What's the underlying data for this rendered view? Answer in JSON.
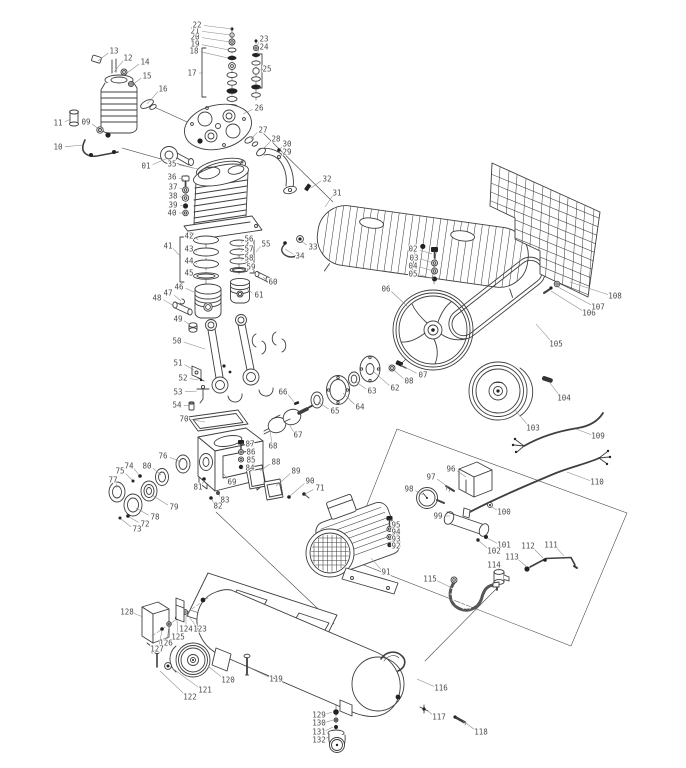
{
  "figure": {
    "type": "exploded-parts-diagram",
    "subject": "Belt-driven piston air compressor exploded view with numbered callouts",
    "canvas": {
      "width": 686,
      "height": 768
    },
    "colors": {
      "background": "#ffffff",
      "line": "#3f3f3f",
      "label": "#4a4a4a",
      "leader": "#8a8a8a"
    },
    "label_font_size": 7.5,
    "part_numbers_range": "01-132"
  },
  "callouts": [
    {
      "id": "01",
      "x": 146,
      "y": 166,
      "tx": 168,
      "ty": 158
    },
    {
      "id": "02",
      "x": 413,
      "y": 249,
      "tx": 432,
      "ty": 254
    },
    {
      "id": "03",
      "x": 414,
      "y": 258,
      "tx": 433,
      "ty": 263
    },
    {
      "id": "04",
      "x": 413,
      "y": 266,
      "tx": 433,
      "ty": 271
    },
    {
      "id": "05",
      "x": 413,
      "y": 274,
      "tx": 434,
      "ty": 279
    },
    {
      "id": "06",
      "x": 386,
      "y": 289,
      "tx": 407,
      "ty": 306
    },
    {
      "id": "07",
      "x": 423,
      "y": 375,
      "tx": 401,
      "ty": 365
    },
    {
      "id": "08",
      "x": 409,
      "y": 381,
      "tx": 393,
      "ty": 369
    },
    {
      "id": "09",
      "x": 86,
      "y": 122,
      "tx": 100,
      "ty": 130
    },
    {
      "id": "10",
      "x": 58,
      "y": 147,
      "tx": 83,
      "ty": 145
    },
    {
      "id": "11",
      "x": 58,
      "y": 123,
      "tx": 71,
      "ty": 119
    },
    {
      "id": "12",
      "x": 128,
      "y": 58,
      "tx": 114,
      "ty": 72
    },
    {
      "id": "13",
      "x": 114,
      "y": 51,
      "tx": 98,
      "ty": 61
    },
    {
      "id": "14",
      "x": 145,
      "y": 62,
      "tx": 127,
      "ty": 73
    },
    {
      "id": "15",
      "x": 147,
      "y": 76,
      "tx": 132,
      "ty": 85
    },
    {
      "id": "16",
      "x": 163,
      "y": 89,
      "tx": 147,
      "ty": 104
    },
    {
      "id": "17",
      "x": 192,
      "y": 73,
      "tx": 203,
      "ty": 73
    },
    {
      "id": "18",
      "x": 194,
      "y": 51,
      "tx": 228,
      "ty": 58
    },
    {
      "id": "19",
      "x": 195,
      "y": 44,
      "tx": 229,
      "ty": 50
    },
    {
      "id": "20",
      "x": 195,
      "y": 37,
      "tx": 230,
      "ty": 42
    },
    {
      "id": "21",
      "x": 195,
      "y": 31,
      "tx": 231,
      "ty": 35
    },
    {
      "id": "22",
      "x": 197,
      "y": 25,
      "tx": 232,
      "ty": 29
    },
    {
      "id": "23",
      "x": 264,
      "y": 39,
      "tx": 257,
      "ty": 46
    },
    {
      "id": "24",
      "x": 264,
      "y": 47,
      "tx": 257,
      "ty": 54
    },
    {
      "id": "25",
      "x": 267,
      "y": 69,
      "tx": 261,
      "ty": 70
    },
    {
      "id": "26",
      "x": 259,
      "y": 108,
      "tx": 243,
      "ty": 114
    },
    {
      "id": "27",
      "x": 263,
      "y": 130,
      "tx": 251,
      "ty": 139
    },
    {
      "id": "28",
      "x": 276,
      "y": 139,
      "tx": 264,
      "ty": 148
    },
    {
      "id": "29",
      "x": 287,
      "y": 152,
      "tx": 281,
      "ty": 156
    },
    {
      "id": "30",
      "x": 287,
      "y": 144,
      "tx": 280,
      "ty": 150
    },
    {
      "id": "31",
      "x": 337,
      "y": 193,
      "tx": 325,
      "ty": 207
    },
    {
      "id": "32",
      "x": 327,
      "y": 179,
      "tx": 311,
      "ty": 188
    },
    {
      "id": "33",
      "x": 313,
      "y": 247,
      "tx": 300,
      "ty": 240
    },
    {
      "id": "34",
      "x": 300,
      "y": 256,
      "tx": 285,
      "ty": 249
    },
    {
      "id": "35",
      "x": 172,
      "y": 164,
      "tx": 198,
      "ty": 169
    },
    {
      "id": "36",
      "x": 172,
      "y": 177,
      "tx": 184,
      "ty": 180
    },
    {
      "id": "37",
      "x": 173,
      "y": 187,
      "tx": 184,
      "ty": 190
    },
    {
      "id": "38",
      "x": 173,
      "y": 196,
      "tx": 184,
      "ty": 198
    },
    {
      "id": "39",
      "x": 173,
      "y": 205,
      "tx": 184,
      "ty": 206
    },
    {
      "id": "40",
      "x": 172,
      "y": 213,
      "tx": 184,
      "ty": 213
    },
    {
      "id": "41",
      "x": 168,
      "y": 246,
      "tx": 181,
      "ty": 257
    },
    {
      "id": "42",
      "x": 189,
      "y": 236,
      "tx": 198,
      "ty": 240
    },
    {
      "id": "43",
      "x": 189,
      "y": 249,
      "tx": 197,
      "ty": 252
    },
    {
      "id": "44",
      "x": 189,
      "y": 261,
      "tx": 197,
      "ty": 264
    },
    {
      "id": "45",
      "x": 189,
      "y": 273,
      "tx": 197,
      "ty": 276
    },
    {
      "id": "46",
      "x": 179,
      "y": 287,
      "tx": 196,
      "ty": 293
    },
    {
      "id": "47",
      "x": 168,
      "y": 293,
      "tx": 181,
      "ty": 301
    },
    {
      "id": "48",
      "x": 157,
      "y": 298,
      "tx": 174,
      "ty": 306
    },
    {
      "id": "49",
      "x": 178,
      "y": 319,
      "tx": 190,
      "ty": 325
    },
    {
      "id": "50",
      "x": 177,
      "y": 341,
      "tx": 205,
      "ty": 349
    },
    {
      "id": "51",
      "x": 178,
      "y": 363,
      "tx": 194,
      "ty": 370
    },
    {
      "id": "52",
      "x": 183,
      "y": 378,
      "tx": 198,
      "ty": 380
    },
    {
      "id": "53",
      "x": 178,
      "y": 392,
      "tx": 197,
      "ty": 391
    },
    {
      "id": "54",
      "x": 177,
      "y": 405,
      "tx": 190,
      "ty": 406
    },
    {
      "id": "55",
      "x": 266,
      "y": 244,
      "tx": 256,
      "ty": 252
    },
    {
      "id": "56",
      "x": 249,
      "y": 239,
      "tx": 241,
      "ty": 243
    },
    {
      "id": "57",
      "x": 249,
      "y": 249,
      "tx": 241,
      "ty": 252
    },
    {
      "id": "58",
      "x": 249,
      "y": 258,
      "tx": 241,
      "ty": 261
    },
    {
      "id": "59",
      "x": 251,
      "y": 267,
      "tx": 242,
      "ty": 270
    },
    {
      "id": "60",
      "x": 273,
      "y": 282,
      "tx": 263,
      "ty": 277
    },
    {
      "id": "61",
      "x": 259,
      "y": 295,
      "tx": 247,
      "ty": 289
    },
    {
      "id": "62",
      "x": 395,
      "y": 388,
      "tx": 374,
      "ty": 372
    },
    {
      "id": "63",
      "x": 372,
      "y": 391,
      "tx": 355,
      "ty": 381
    },
    {
      "id": "64",
      "x": 360,
      "y": 407,
      "tx": 343,
      "ty": 393
    },
    {
      "id": "65",
      "x": 335,
      "y": 411,
      "tx": 318,
      "ty": 402
    },
    {
      "id": "66",
      "x": 283,
      "y": 392,
      "tx": 294,
      "ty": 402
    },
    {
      "id": "67",
      "x": 298,
      "y": 435,
      "tx": 289,
      "ty": 424
    },
    {
      "id": "68",
      "x": 273,
      "y": 446,
      "tx": 270,
      "ty": 430
    },
    {
      "id": "69",
      "x": 232,
      "y": 482,
      "tx": 223,
      "ty": 473
    },
    {
      "id": "70",
      "x": 184,
      "y": 419,
      "tx": 205,
      "ty": 422
    },
    {
      "id": "71",
      "x": 320,
      "y": 488,
      "tx": 305,
      "ty": 494
    },
    {
      "id": "72",
      "x": 145,
      "y": 524,
      "tx": 129,
      "ty": 517
    },
    {
      "id": "73",
      "x": 137,
      "y": 529,
      "tx": 121,
      "ty": 519
    },
    {
      "id": "74",
      "x": 129,
      "y": 466,
      "tx": 139,
      "ty": 475
    },
    {
      "id": "75",
      "x": 120,
      "y": 471,
      "tx": 132,
      "ty": 480
    },
    {
      "id": "76",
      "x": 163,
      "y": 456,
      "tx": 181,
      "ty": 462
    },
    {
      "id": "77",
      "x": 113,
      "y": 480,
      "tx": 117,
      "ty": 488
    },
    {
      "id": "78",
      "x": 155,
      "y": 517,
      "tx": 136,
      "ty": 508
    },
    {
      "id": "79",
      "x": 174,
      "y": 507,
      "tx": 152,
      "ty": 495
    },
    {
      "id": "80",
      "x": 147,
      "y": 466,
      "tx": 161,
      "ty": 475
    },
    {
      "id": "81",
      "x": 198,
      "y": 487,
      "tx": 204,
      "ty": 480
    },
    {
      "id": "82",
      "x": 218,
      "y": 506,
      "tx": 212,
      "ty": 499
    },
    {
      "id": "83",
      "x": 225,
      "y": 500,
      "tx": 219,
      "ty": 494
    },
    {
      "id": "84",
      "x": 250,
      "y": 468,
      "tx": 242,
      "ty": 467
    },
    {
      "id": "85",
      "x": 251,
      "y": 460,
      "tx": 242,
      "ty": 459
    },
    {
      "id": "86",
      "x": 251,
      "y": 452,
      "tx": 242,
      "ty": 451
    },
    {
      "id": "87",
      "x": 250,
      "y": 444,
      "tx": 242,
      "ty": 443
    },
    {
      "id": "88",
      "x": 276,
      "y": 462,
      "tx": 260,
      "ty": 471
    },
    {
      "id": "89",
      "x": 296,
      "y": 471,
      "tx": 276,
      "ty": 486
    },
    {
      "id": "90",
      "x": 310,
      "y": 481,
      "tx": 290,
      "ty": 496
    },
    {
      "id": "91",
      "x": 386,
      "y": 572,
      "tx": 371,
      "ty": 558
    },
    {
      "id": "92",
      "x": 396,
      "y": 546,
      "tx": 391,
      "ty": 545
    },
    {
      "id": "93",
      "x": 396,
      "y": 539,
      "tx": 391,
      "ty": 537
    },
    {
      "id": "94",
      "x": 396,
      "y": 532,
      "tx": 391,
      "ty": 529
    },
    {
      "id": "95",
      "x": 396,
      "y": 525,
      "tx": 391,
      "ty": 519
    },
    {
      "id": "96",
      "x": 451,
      "y": 469,
      "tx": 466,
      "ty": 477
    },
    {
      "id": "97",
      "x": 431,
      "y": 477,
      "tx": 448,
      "ty": 487
    },
    {
      "id": "98",
      "x": 409,
      "y": 489,
      "tx": 423,
      "ty": 495
    },
    {
      "id": "99",
      "x": 438,
      "y": 516,
      "tx": 450,
      "ty": 516
    },
    {
      "id": "100",
      "x": 504,
      "y": 512,
      "tx": 490,
      "ty": 506
    },
    {
      "id": "101",
      "x": 504,
      "y": 545,
      "tx": 487,
      "ty": 538
    },
    {
      "id": "102",
      "x": 494,
      "y": 551,
      "tx": 479,
      "ty": 541
    },
    {
      "id": "103",
      "x": 533,
      "y": 428,
      "tx": 515,
      "ty": 410
    },
    {
      "id": "104",
      "x": 564,
      "y": 398,
      "tx": 550,
      "ty": 383
    },
    {
      "id": "105",
      "x": 556,
      "y": 344,
      "tx": 536,
      "ty": 324
    },
    {
      "id": "106",
      "x": 589,
      "y": 313,
      "tx": 551,
      "ty": 291
    },
    {
      "id": "107",
      "x": 598,
      "y": 307,
      "tx": 558,
      "ty": 287
    },
    {
      "id": "108",
      "x": 615,
      "y": 296,
      "tx": 570,
      "ty": 282
    },
    {
      "id": "109",
      "x": 598,
      "y": 436,
      "tx": 576,
      "ty": 429
    },
    {
      "id": "110",
      "x": 597,
      "y": 482,
      "tx": 567,
      "ty": 472
    },
    {
      "id": "111",
      "x": 551,
      "y": 545,
      "tx": 564,
      "ty": 556
    },
    {
      "id": "112",
      "x": 528,
      "y": 546,
      "tx": 543,
      "ty": 558
    },
    {
      "id": "113",
      "x": 512,
      "y": 557,
      "tx": 527,
      "ty": 567
    },
    {
      "id": "114",
      "x": 494,
      "y": 565,
      "tx": 499,
      "ty": 571
    },
    {
      "id": "115",
      "x": 430,
      "y": 579,
      "tx": 450,
      "ty": 587
    },
    {
      "id": "116",
      "x": 441,
      "y": 688,
      "tx": 417,
      "ty": 679
    },
    {
      "id": "117",
      "x": 439,
      "y": 717,
      "tx": 428,
      "ty": 711
    },
    {
      "id": "118",
      "x": 481,
      "y": 732,
      "tx": 463,
      "ty": 721
    },
    {
      "id": "119",
      "x": 276,
      "y": 679,
      "tx": 250,
      "ty": 668
    },
    {
      "id": "120",
      "x": 228,
      "y": 680,
      "tx": 208,
      "ty": 666
    },
    {
      "id": "121",
      "x": 205,
      "y": 690,
      "tx": 172,
      "ty": 668
    },
    {
      "id": "122",
      "x": 190,
      "y": 697,
      "tx": 160,
      "ty": 671
    },
    {
      "id": "123",
      "x": 200,
      "y": 629,
      "tx": 183,
      "ty": 608
    },
    {
      "id": "124",
      "x": 186,
      "y": 629,
      "tx": 186,
      "ty": 614
    },
    {
      "id": "125",
      "x": 178,
      "y": 637,
      "tx": 177,
      "ty": 620
    },
    {
      "id": "126",
      "x": 166,
      "y": 643,
      "tx": 169,
      "ty": 626
    },
    {
      "id": "127",
      "x": 157,
      "y": 649,
      "tx": 162,
      "ty": 631
    },
    {
      "id": "128",
      "x": 127,
      "y": 612,
      "tx": 143,
      "ty": 617
    },
    {
      "id": "129",
      "x": 319,
      "y": 715,
      "tx": 332,
      "ty": 712
    },
    {
      "id": "130",
      "x": 319,
      "y": 723,
      "tx": 333,
      "ty": 720
    },
    {
      "id": "131",
      "x": 319,
      "y": 732,
      "tx": 333,
      "ty": 727
    },
    {
      "id": "132",
      "x": 319,
      "y": 740,
      "tx": 330,
      "ty": 736
    }
  ]
}
